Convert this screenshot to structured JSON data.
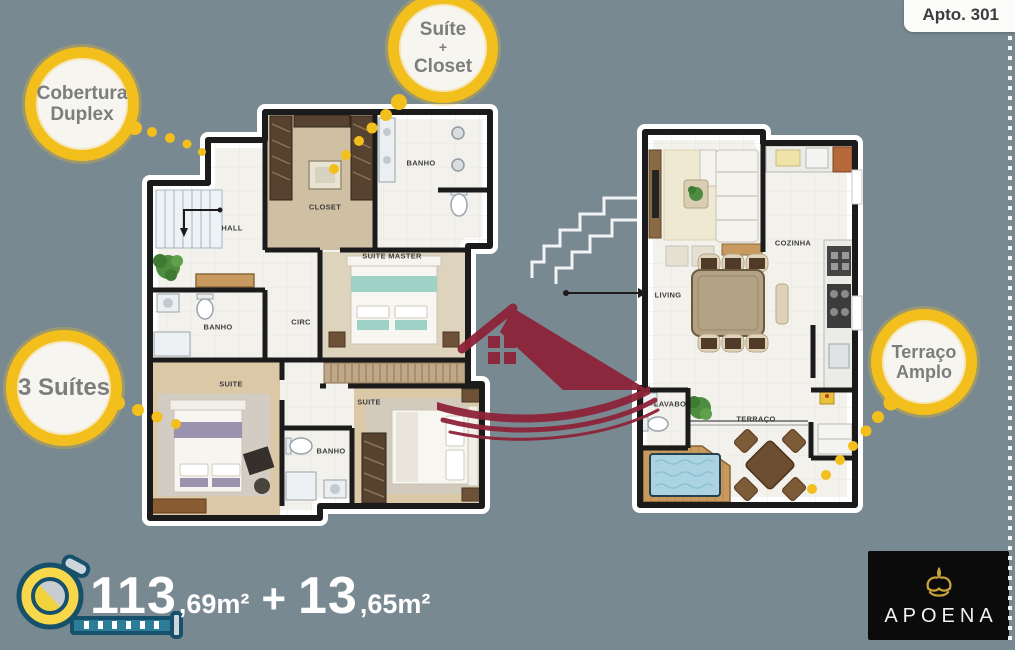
{
  "canvas": {
    "background": "#798992"
  },
  "header": {
    "apto_label": "Apto. 301"
  },
  "callouts": {
    "cobertura": {
      "line1": "Cobertura",
      "line2": "Duplex"
    },
    "suite_closet": {
      "line1": "Suíte",
      "line2": "+",
      "line3": "Closet"
    },
    "tres_suites": {
      "line1": "3 Suítes"
    },
    "terraco": {
      "line1": "Terraço",
      "line2": "Amplo"
    }
  },
  "plans": {
    "upper": {
      "rooms": {
        "hall": "HALL",
        "closet": "CLOSET",
        "banho_suite_master": "BANHO",
        "suite_master": "SUITE MASTER",
        "banho_suite_2": "BANHO",
        "circ": "CIRC",
        "suite_2": "SUITE",
        "suite_3": "SUITE",
        "banho_suite_3": "BANHO"
      }
    },
    "lower": {
      "rooms": {
        "living": "LIVING",
        "cozinha": "COZINHA",
        "lavabo": "LAVABO",
        "terraco": "TERRAÇO"
      }
    }
  },
  "area_banner": {
    "value1_int": "113",
    "value1_frac": ",69m²",
    "plus": "+",
    "value2_int": "13",
    "value2_frac": ",65m²"
  },
  "brand": {
    "name": "APOENA"
  },
  "colors": {
    "background": "#798992",
    "accent_yellow": "#f2bf1d",
    "watermark_red": "#8e2339",
    "logo_gold": "#c9a13b",
    "wall_black": "#1b1b1b"
  }
}
